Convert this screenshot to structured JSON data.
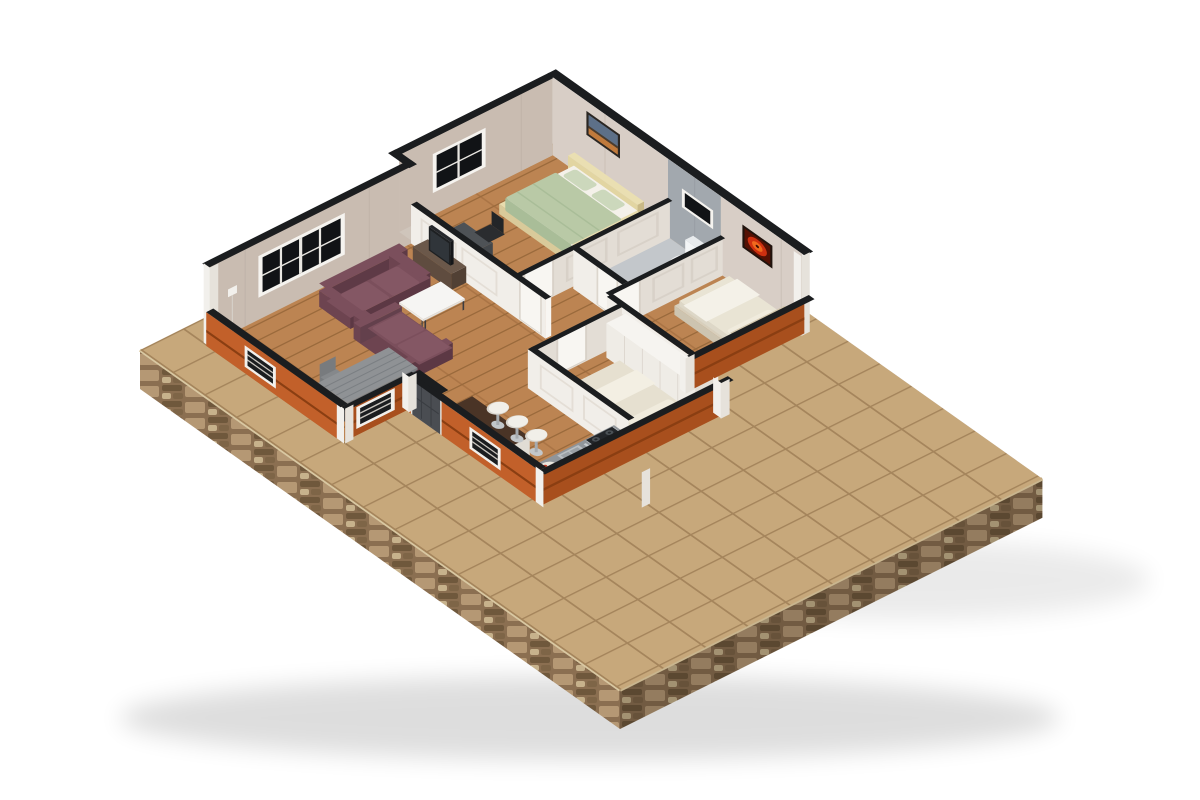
{
  "scene": {
    "kind": "isometric-3d-floor-plan-render",
    "background": "#ffffff",
    "rooms": [
      {
        "name": "living-room",
        "furniture": [
          "sectional-sofa",
          "coffee-table",
          "dining-table",
          "dining-chairs",
          "tv-cabinet",
          "tv",
          "window",
          "wall-switch"
        ]
      },
      {
        "name": "master-bedroom",
        "furniture": [
          "double-bed",
          "green-bedding",
          "pillows",
          "desk",
          "desk-chair",
          "wall-photo",
          "window"
        ]
      },
      {
        "name": "bathroom",
        "furniture": [
          "toilet",
          "floor-basin",
          "small-window"
        ]
      },
      {
        "name": "bedroom-right",
        "furniture": [
          "single-bed",
          "red-wall-art"
        ]
      },
      {
        "name": "bedroom-front",
        "furniture": [
          "single-bed",
          "wardrobe-row"
        ]
      },
      {
        "name": "kitchen",
        "furniture": [
          "bar-counter",
          "bar-stools",
          "kitchen-counter",
          "sink",
          "gas-hob",
          "fruit-plate",
          "entry-door",
          "wall-box"
        ]
      },
      {
        "name": "patio",
        "furniture": []
      }
    ]
  },
  "palette": {
    "bg": "#ffffff",
    "tile": "#c7a87b",
    "grout": "#a5855c",
    "wood": "#bc8452",
    "woodLine": "#9a6a3c",
    "woodSeam": "#aa7445",
    "stone": "#8b6f51",
    "stoneLight": "#b59874",
    "stoneDark": "#6f583c",
    "stonePale": "#c7b28c",
    "stoneMid": "#7e6547",
    "trim": "#d9c8a2",
    "wallBeigeSE": "#c9bcb1",
    "wallBeigeSW": "#d8cec6",
    "wallJog": "#cfc5bb",
    "wallGray": "#a2a8ae",
    "bathFloor": "#c3c7cb",
    "capDark": "#1b1d1f",
    "cutWallSW": "#f1eee9",
    "cutWallSE": "#e3ddd5",
    "cutWallEnd": "#f8f6f2",
    "panelLine": "#d8d1c8",
    "orange": "#c2602a",
    "orangeDark": "#a84f1d",
    "groove": "#8a3e12",
    "postWhite": "#f2f0ec",
    "postShade": "#e6e2db",
    "windowFrame": "#f5f3ef",
    "windowPane": "#111316",
    "doorDark": "#4a4d52",
    "doorLine": "#3a3d42",
    "sofa": "#6d4450",
    "sofaDark": "#5c3844",
    "sofaLight": "#7b4f5c",
    "cushion": "#845764",
    "coffeeTop": "#f6f5f3",
    "tableLeg": "#3c3c40",
    "diningGray": "#8f9295",
    "diningEdge": "#7b7f83",
    "chairGray": "#787b7e",
    "cabinetBrown": "#5f4c3f",
    "cabinetSide": "#514034",
    "cabinetTop": "#6b584a",
    "tvBlack": "#1e2022",
    "screen": "#30353a",
    "deskGray": "#4e5256",
    "chairBlack": "#2a2c2f",
    "bedCream": "#e8dcae",
    "bedCreamDark": "#d9ca9a",
    "headboard": "#e2d5a2",
    "mattress": "#f4f1ea",
    "duvetGreen": "#b9c9a6",
    "duvetShade": "#a9bd98",
    "pillowGreen": "#ccd8bc",
    "bedding2": "#e9e4d4",
    "bedFrame2": "#d8cfbc",
    "backrestTan": "#c8bca3",
    "blanket": "#f4f1e8",
    "pillowCream": "#f0ebdd",
    "wardrobe": "#efece6",
    "wardrobeTop": "#f6f4f0",
    "counterGray": "#90959a",
    "steel": "#b9bec2",
    "steelDark": "#9aa0a5",
    "hobBlack": "#23262a",
    "burner": "#4a5055",
    "barTop": "#4a3426",
    "stoolWhite": "#f1efe9",
    "stoolLeg": "#a6abaf",
    "toilet": "#f3f5f6",
    "toiletShade": "#e4e7e9",
    "artRed": "#cf3010",
    "artRedHot": "#f06a1e",
    "artFrame": "#20130d",
    "photoFrame": "#2b2723",
    "photoSky": "#5d7088",
    "photoWarm": "#c07a3c",
    "photoMountain": "#4a3c2e"
  }
}
